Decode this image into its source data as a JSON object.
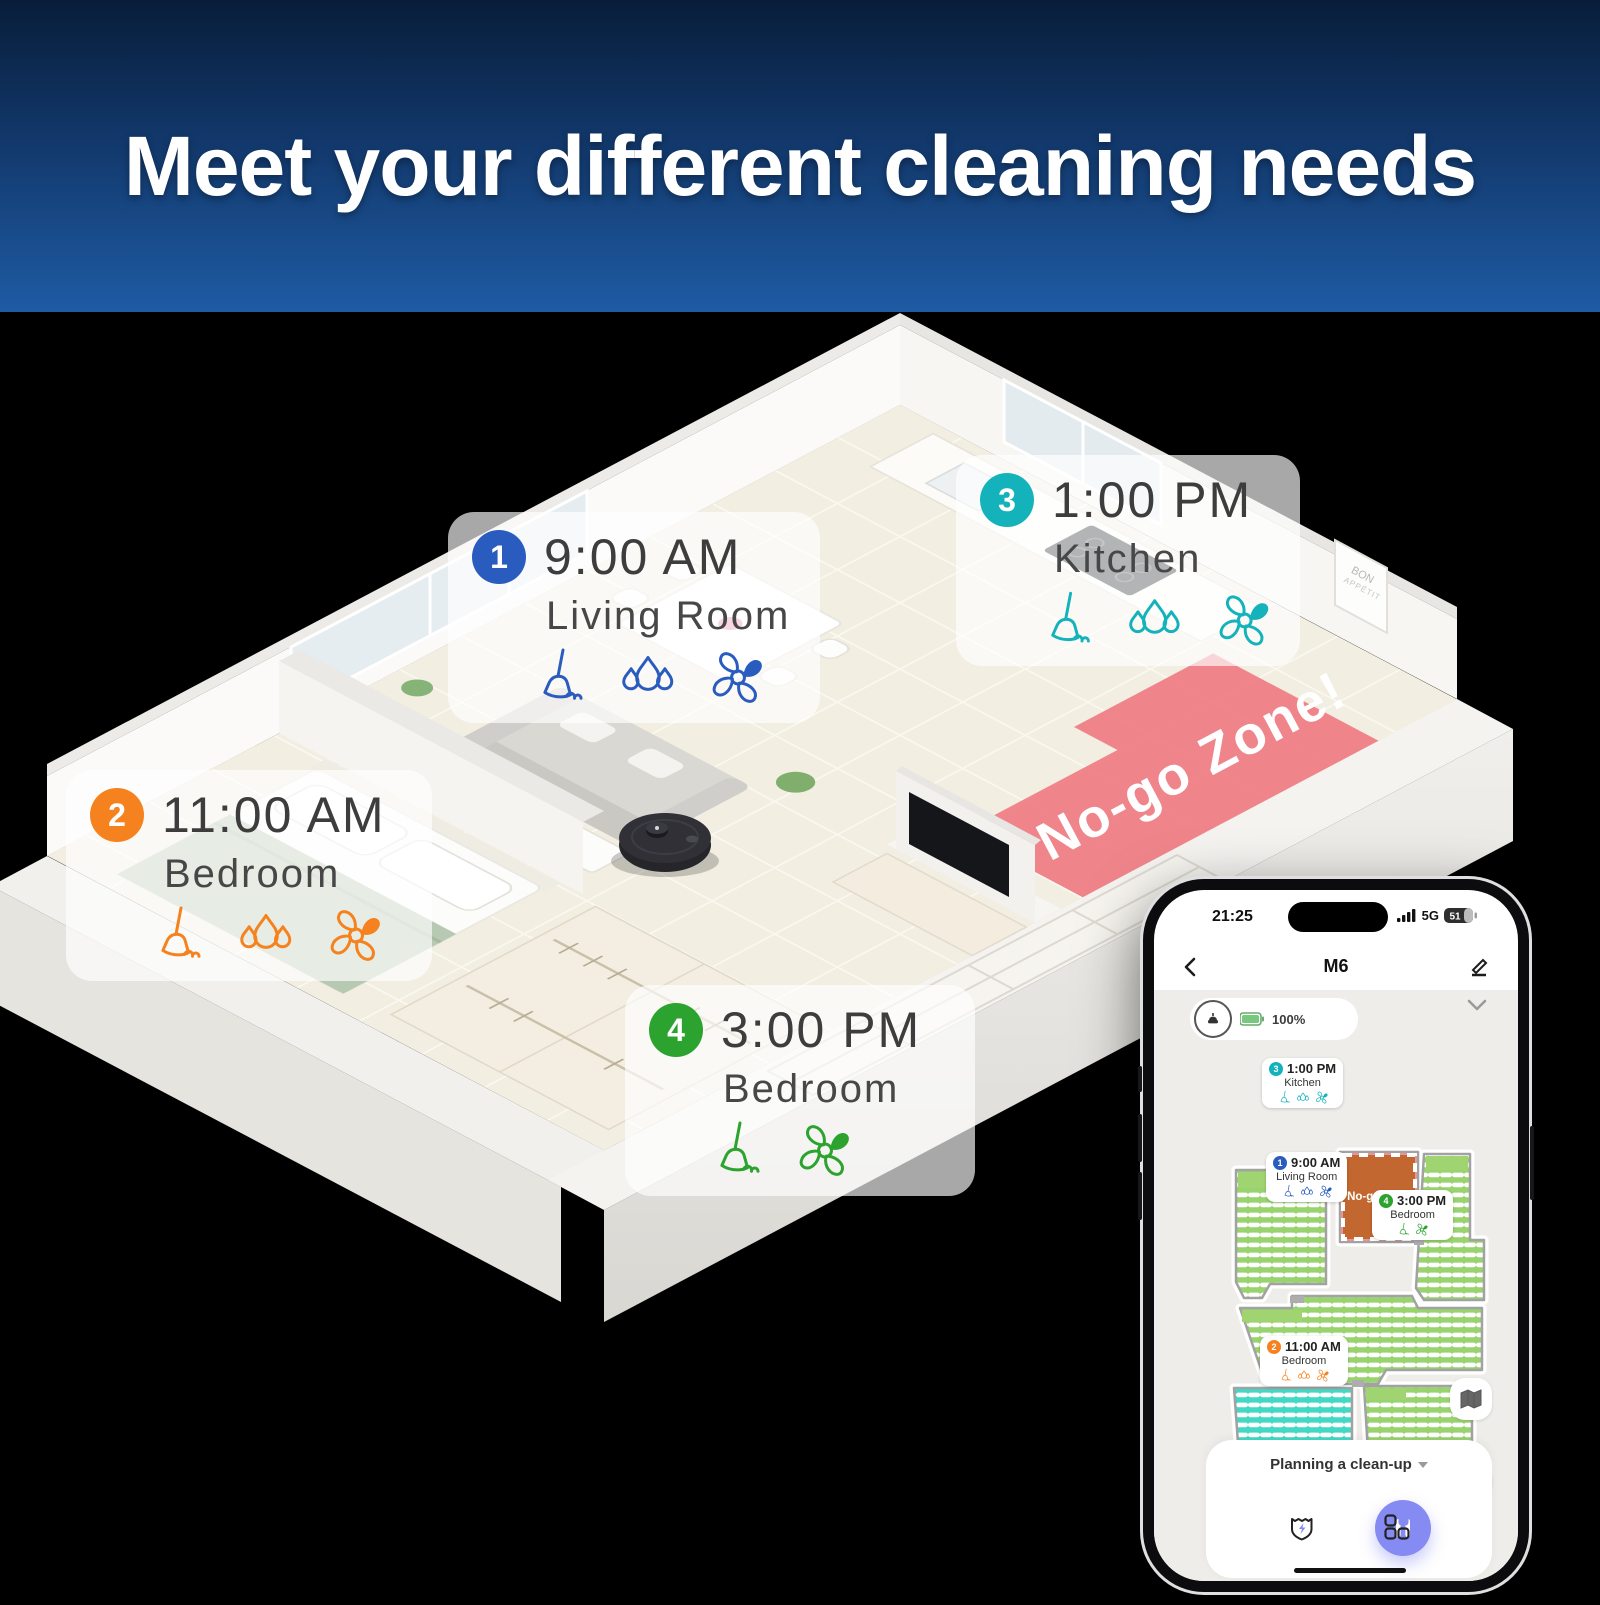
{
  "header": {
    "title": "Meet your different cleaning needs"
  },
  "scene": {
    "no_go_label": "No-go Zone!",
    "poster": {
      "line1": "BON",
      "line2": "APPÉTIT"
    },
    "schedules": [
      {
        "num": "1",
        "time": "9:00 AM",
        "room": "Living Room",
        "color": "#2a5cc0",
        "tasks": [
          "vacuum",
          "mop",
          "fan"
        ]
      },
      {
        "num": "2",
        "time": "11:00 AM",
        "room": "Bedroom",
        "color": "#f5821f",
        "tasks": [
          "vacuum",
          "mop",
          "fan"
        ]
      },
      {
        "num": "3",
        "time": "1:00 PM",
        "room": "Kitchen",
        "color": "#14b2bb",
        "tasks": [
          "vacuum",
          "mop",
          "fan"
        ]
      },
      {
        "num": "4",
        "time": "3:00 PM",
        "room": "Bedroom",
        "color": "#2ba32e",
        "tasks": [
          "vacuum",
          "fan"
        ]
      }
    ]
  },
  "phone": {
    "status": {
      "time": "21:25",
      "network": "5G",
      "battery": "51"
    },
    "nav": {
      "title": "M6"
    },
    "robot_card": {
      "battery": "100%"
    },
    "map": {
      "no_go_label": "No-go Zone"
    },
    "footer": {
      "mode_label": "Planning a clean-up"
    }
  },
  "colors": {
    "header_gradient_top": "#081d3a",
    "header_gradient_bottom": "#1e5ba4",
    "no_go_red": "#ef7d83",
    "map_green": "#98d36d",
    "map_teal": "#40d9c4",
    "map_no_go_square": "#c2672f",
    "pause_button": "#858bf2",
    "accent_blue": "#2a5cc0",
    "accent_orange": "#f5821f",
    "accent_teal": "#14b2bb",
    "accent_green": "#2ba32e"
  }
}
